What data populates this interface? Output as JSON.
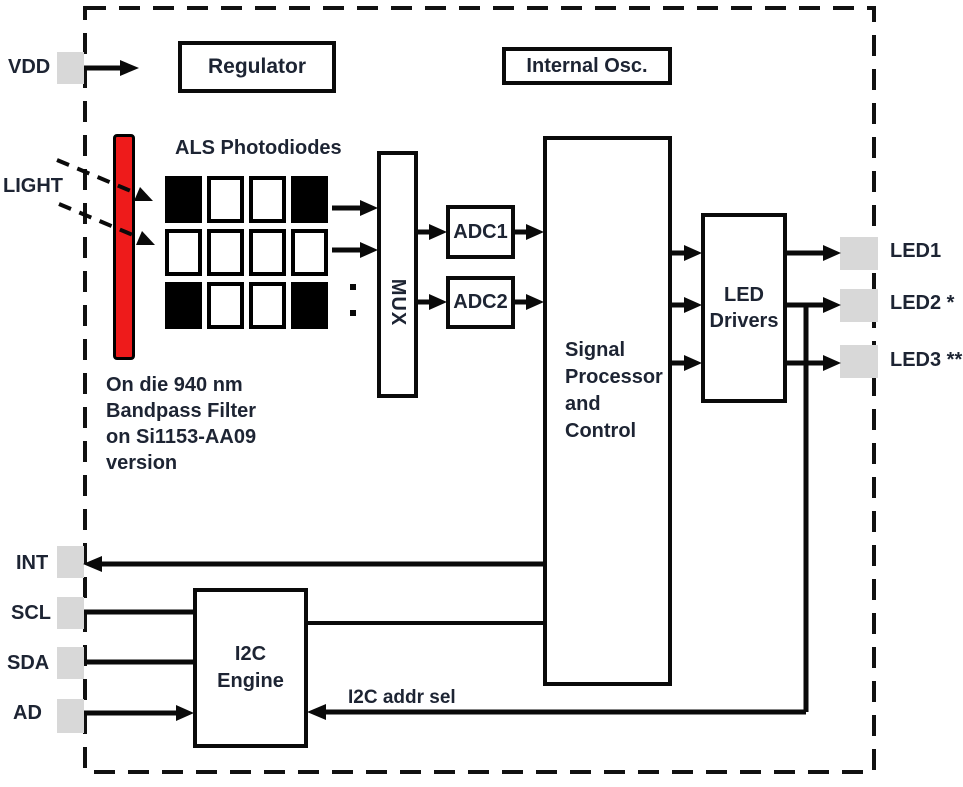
{
  "chip": {
    "pins_left": [
      {
        "label": "VDD"
      },
      {
        "label": "LIGHT"
      },
      {
        "label": "INT"
      },
      {
        "label": "SCL"
      },
      {
        "label": "SDA"
      },
      {
        "label": "AD"
      }
    ],
    "pins_right": [
      {
        "label": "LED1"
      },
      {
        "label": "LED2 *"
      },
      {
        "label": "LED3 **"
      }
    ],
    "blocks": {
      "regulator": "Regulator",
      "internal_osc": "Internal Osc.",
      "als_title": "ALS Photodiodes",
      "mux": "MUX",
      "adc1": "ADC1",
      "adc2": "ADC2",
      "signal_processor": "Signal\nProcessor\nand\nControl",
      "led_drivers": "LED\nDrivers",
      "i2c_engine": "I2C\nEngine"
    },
    "annotations": {
      "filter_note": "On die 940 nm\nBandpass Filter\non Si1153-AA09\nversion",
      "i2c_addr_sel": "I2C addr sel"
    },
    "photodiode_grid": {
      "rows": [
        [
          "black",
          "white",
          "white",
          "black"
        ],
        [
          "white",
          "white",
          "white",
          "white"
        ],
        [
          "black",
          "white",
          "white",
          "black"
        ]
      ]
    },
    "colors": {
      "filter_red": "#ee1b1b",
      "pad_gray": "#d8d8d8",
      "line_black": "#0a0a0a",
      "text": "#1d2433"
    }
  }
}
